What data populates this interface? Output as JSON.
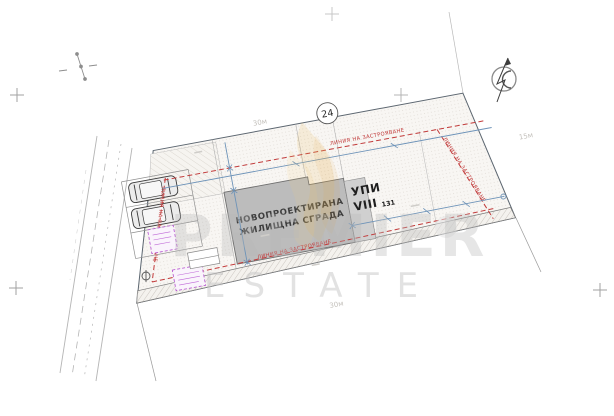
{
  "drawing": {
    "plot": {
      "label_line1": "УПИ",
      "label_line2": "VIII",
      "label_index": "131"
    },
    "building": {
      "label_line1": "НОВОПРОЕКТИРАНА",
      "label_line2": "ЖИЛИЩНА СГРАДА"
    },
    "node_badge": "24",
    "building_line_label": "ЛИНИЯ НА ЗАСТРОЯВАНЕ",
    "dimensions": {
      "top": "30м",
      "right": "15м",
      "bottom": "30м"
    },
    "colors": {
      "building_line_red": "#c23b3b",
      "dimension_blue": "#6e93b8",
      "annotation_purple": "#b44fd0",
      "building_fill": "#bcbcbc",
      "boundary_gray": "#5c6670",
      "watermark_gray": "#bdbdbd",
      "logo_gold": "#e8b74a"
    },
    "icons": {
      "north_arrow": "north-arrow-icon",
      "grid_cross": "grid-cross-icon",
      "car": "car-top-view-icon",
      "survey_point": "survey-point-icon",
      "manhole": "manhole-icon",
      "tree": "tree-icon",
      "logo_flame": "logo-flame-icon"
    }
  },
  "watermark": {
    "line1": "PREMIER",
    "line2": "ESTATE"
  }
}
